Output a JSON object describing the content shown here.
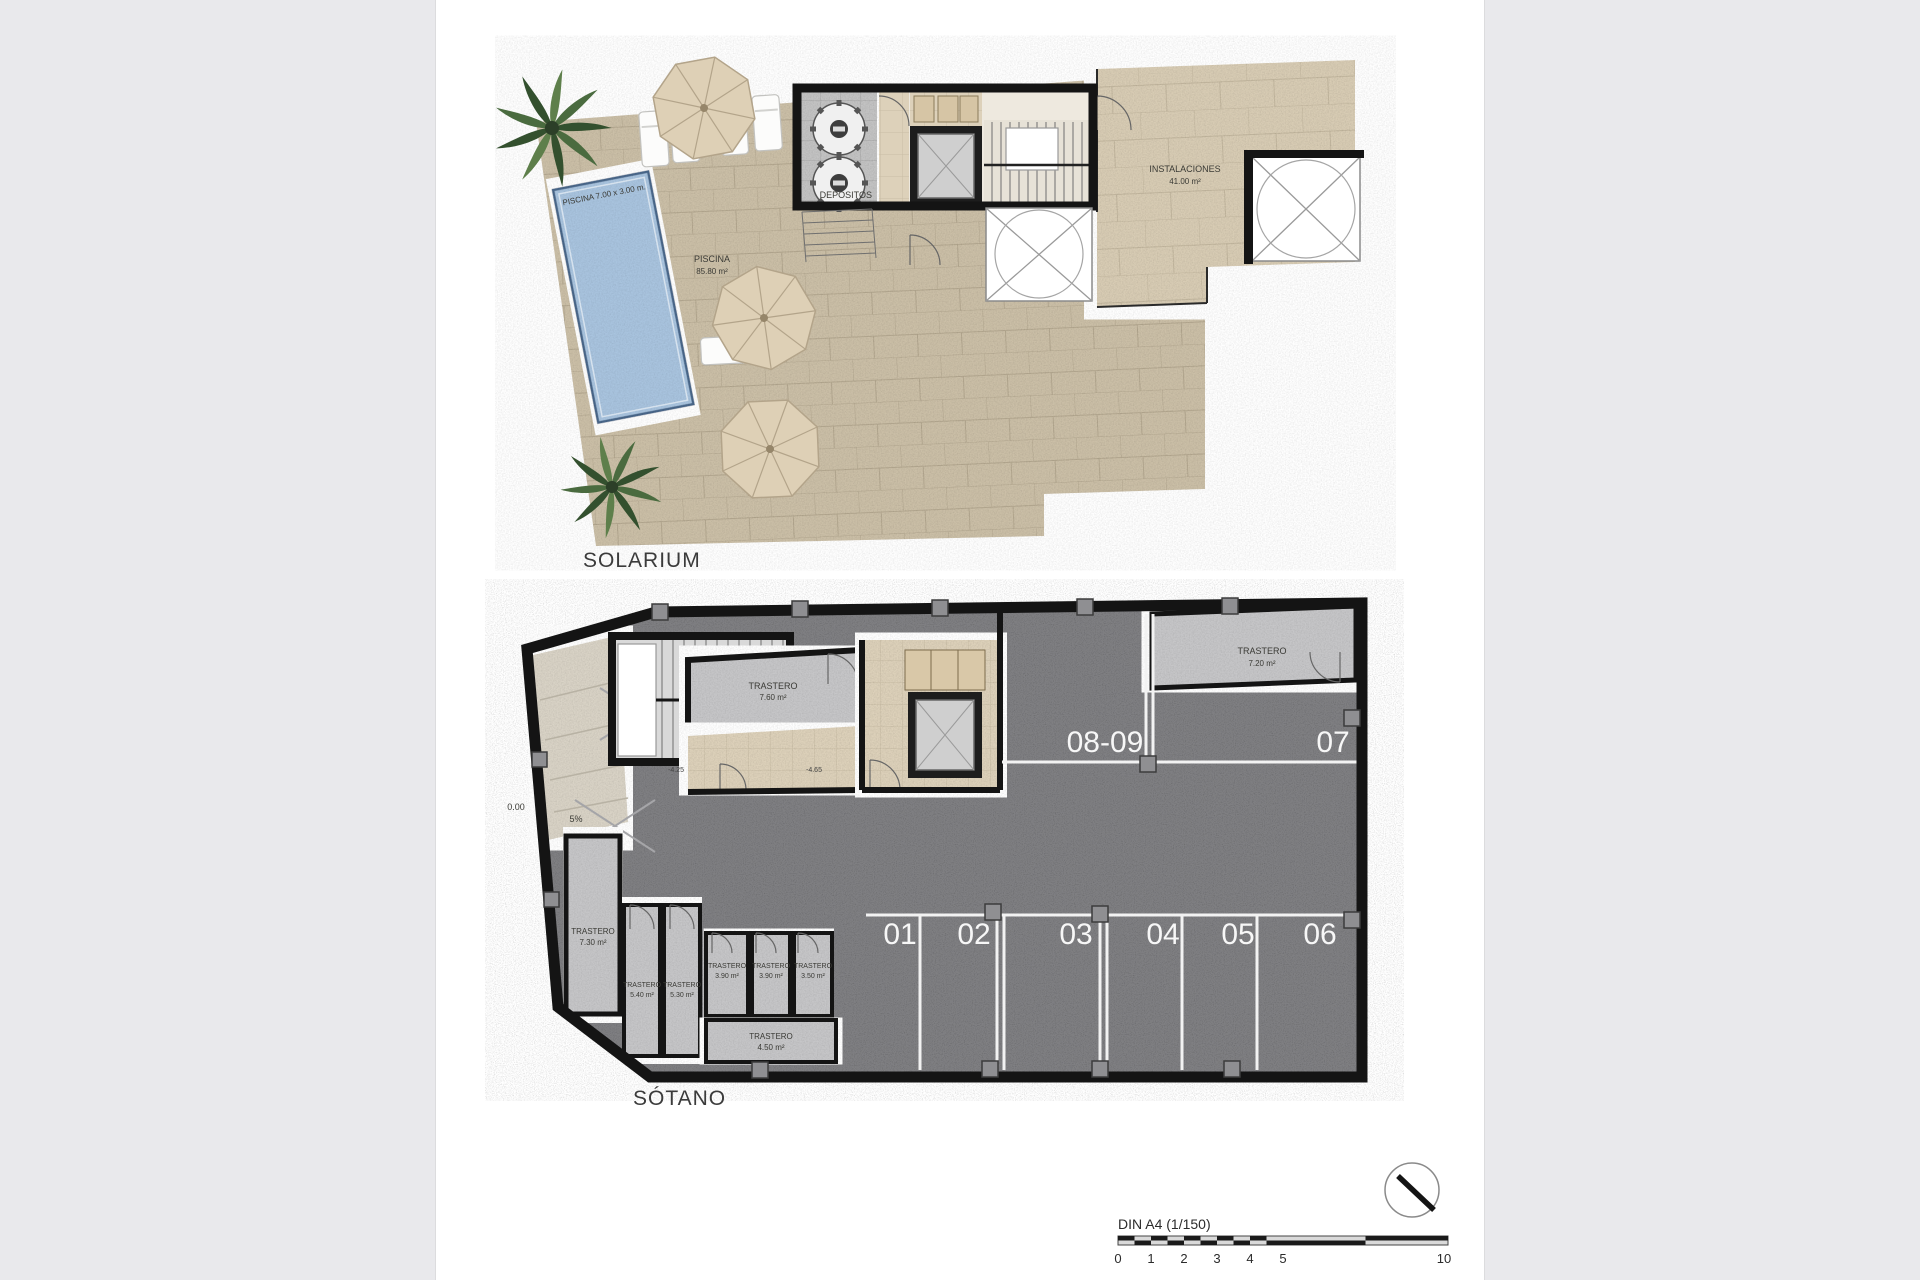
{
  "page": {
    "sheet_bg": "#ffffff",
    "canvas_bg": "#e9e9ec"
  },
  "colors": {
    "pool": "#a9c4df",
    "terrace": "#cbbfa7",
    "instalaciones_floor": "#d8ccb4",
    "parking_floor": "#7f7f82",
    "storage_floor": "#c6c6c8",
    "corridor": "#ddd1ba",
    "wall": "#141414",
    "parking_line": "#f2f2f2",
    "palm": "#3f5c37",
    "parasol": "#ded0b6"
  },
  "solarium": {
    "title": "SOLARIUM",
    "pool_label": "PISCINA 7.00 x 3.00 m.",
    "terrace_room": "PISCINA",
    "terrace_area": "85.80 m²",
    "depositos": "DEPOSITOS",
    "instalaciones": "INSTALACIONES",
    "instalaciones_area": "41.00 m²"
  },
  "sotano": {
    "title": "SÓTANO",
    "parking": [
      "01",
      "02",
      "03",
      "04",
      "05",
      "06"
    ],
    "parking_double": "08-09",
    "parking_right": "07",
    "tr": [
      {
        "label": "TRASTERO",
        "area": "7.60 m²"
      },
      {
        "label": "TRASTERO",
        "area": "7.20 m²"
      },
      {
        "label": "TRASTERO",
        "area": "7.30 m²"
      },
      {
        "label": "TRASTERO",
        "area": "5.40 m²"
      },
      {
        "label": "TRASTERO",
        "area": "5.30 m²"
      },
      {
        "label": "TRASTERO",
        "area": "3.90 m²"
      },
      {
        "label": "TRASTERO",
        "area": "3.90 m²"
      },
      {
        "label": "TRASTERO",
        "area": "3.50 m²"
      },
      {
        "label": "TRASTERO",
        "area": "4.50 m²"
      }
    ],
    "levels": {
      "zero": "0.00",
      "ramp": "5%",
      "mid": "-4.25",
      "lobby": "-4.65"
    }
  },
  "footer": {
    "scale": "DIN A4 (1/150)",
    "ticks": [
      "0",
      "1",
      "2",
      "3",
      "4",
      "5",
      "10"
    ]
  }
}
